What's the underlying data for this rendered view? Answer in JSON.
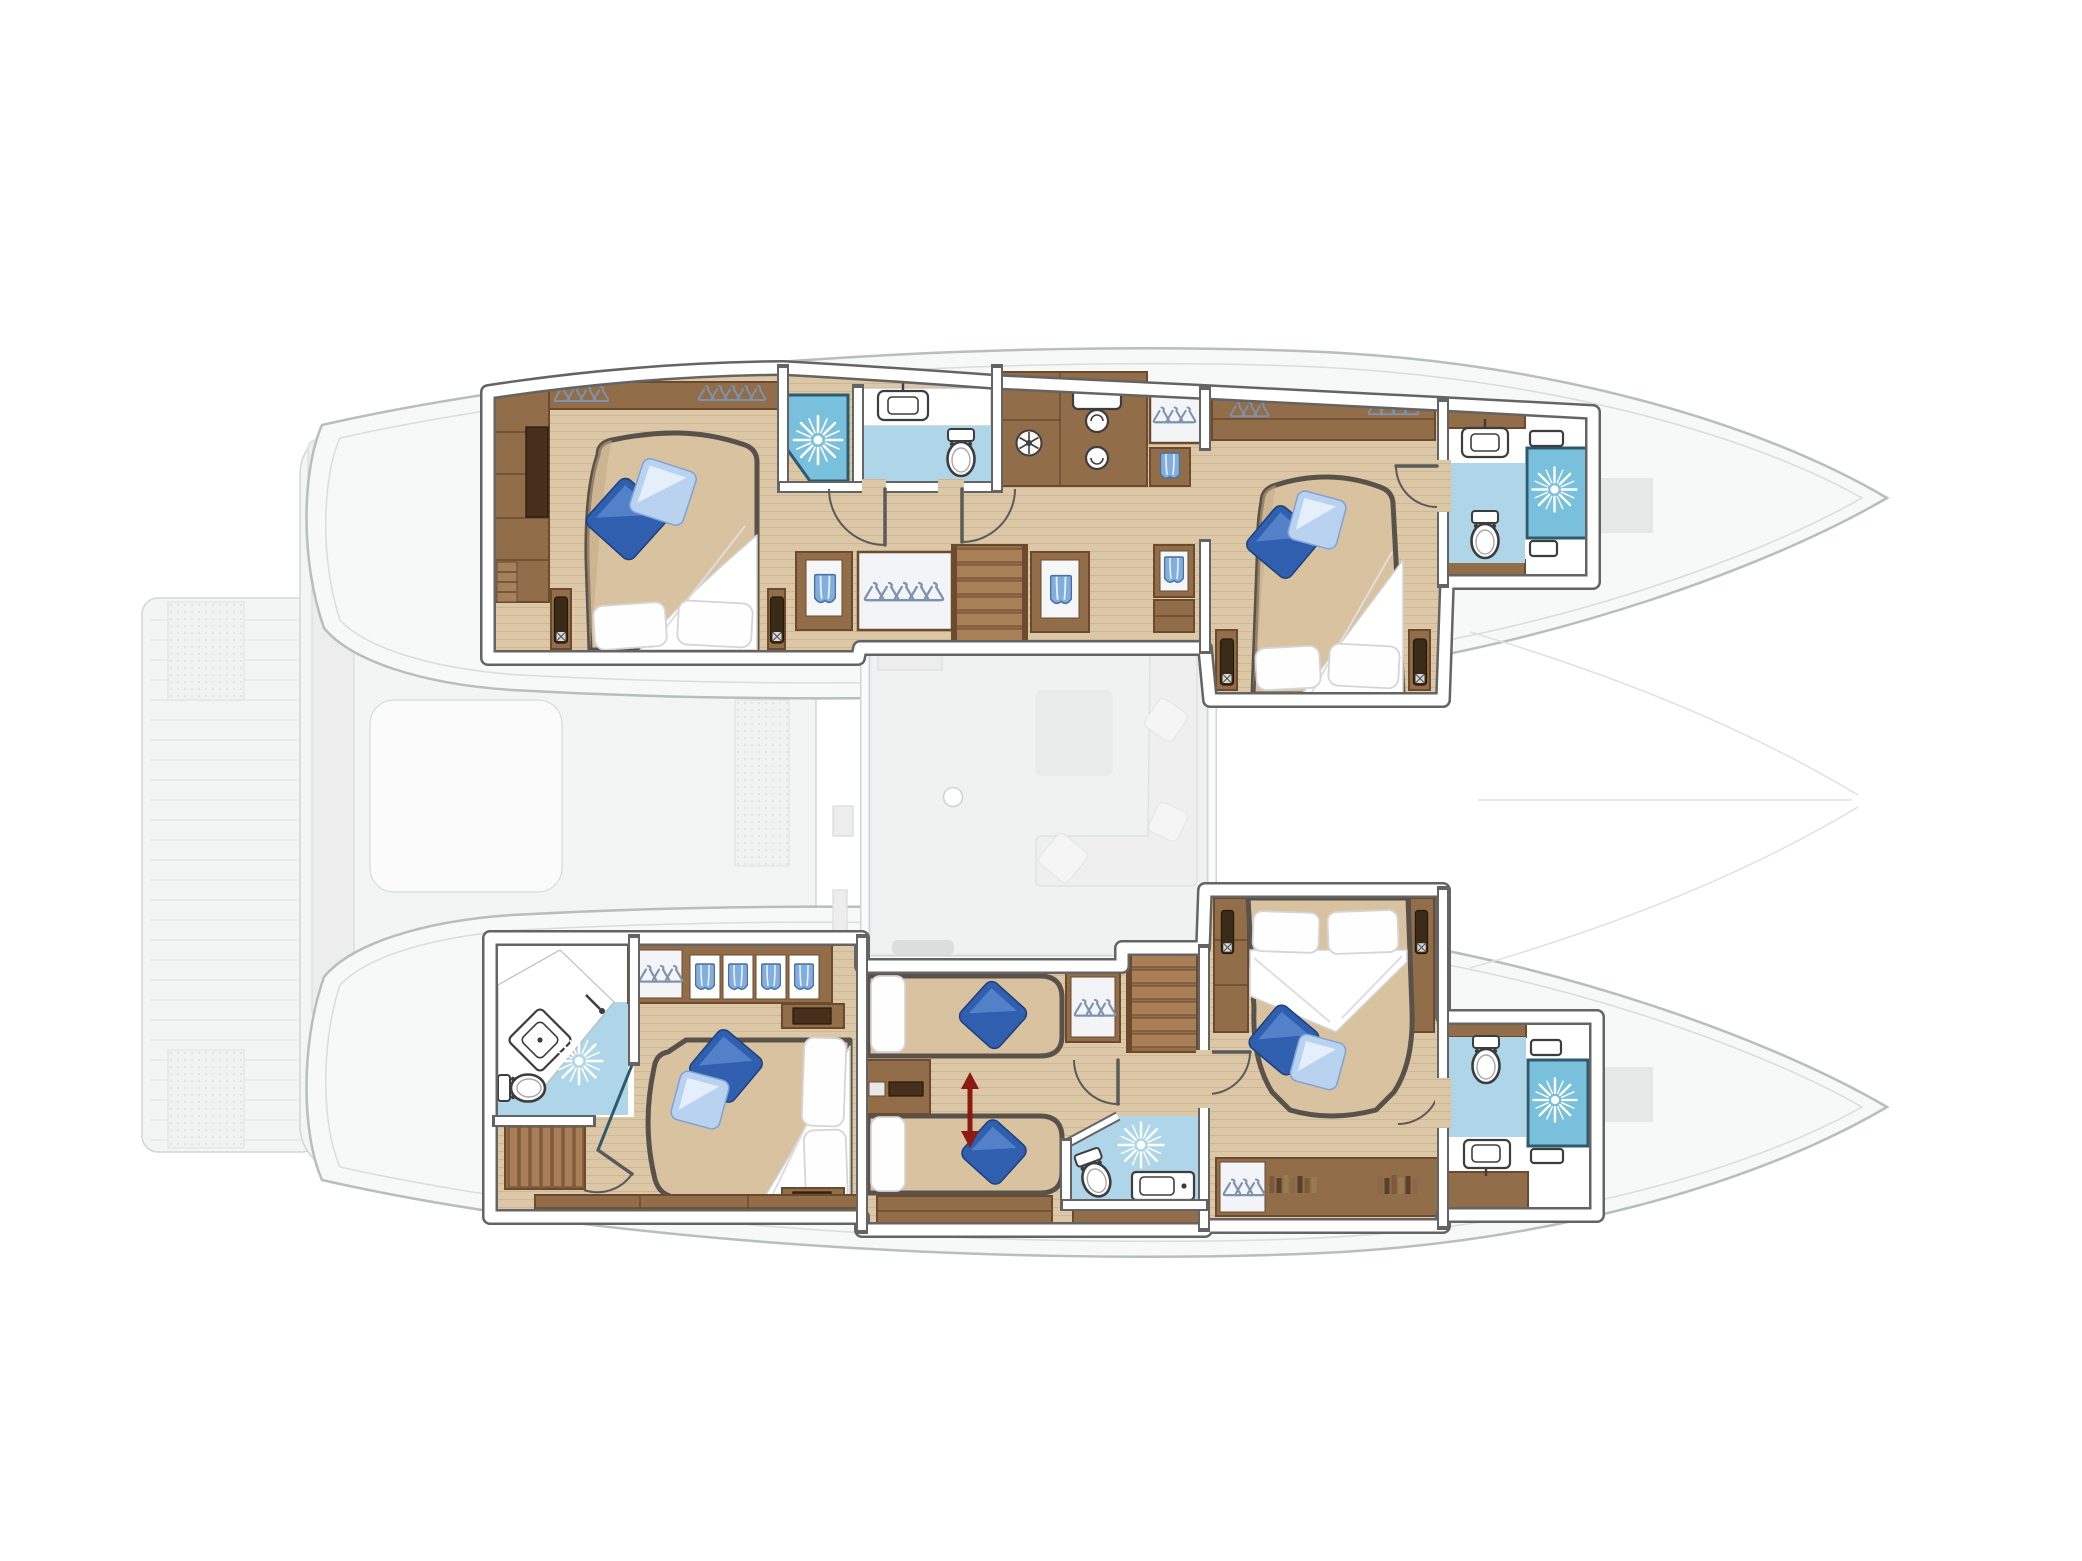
{
  "meta": {
    "type": "yacht floor plan",
    "vessel": "sailing catamaran (twin hulls, bows to the right)",
    "view": "top-down interior deck plan, saloon and exterior decks shown faded",
    "visible_text": []
  },
  "palette": {
    "hullFill": "#f7f8f8",
    "hullLine": "#b7bebe",
    "hullLine2": "#d9dddd",
    "deckFill": "#f3f4f4",
    "deckLine": "#d2d6d6",
    "faintFill": "#ededee",
    "faintLine": "#dfe1e1",
    "platformLine": "#e4e7e7",
    "wallWhite": "#ffffff",
    "wallEdge": "#646464",
    "floorWood": "#dcc7a7",
    "floorWoodLine": "#c3aa85",
    "woodCab": "#916d4a",
    "woodCabDark": "#6b4a2d",
    "woodDeep": "#46301b",
    "stairTread": "#a97f58",
    "mattress": "#d9c29f",
    "mattressShade": "#c3ab87",
    "mattressEdge": "#59524b",
    "bathFloor": "#aed6e8",
    "showerBlue": "#79c0dd",
    "showerFrame": "#2e5a6e",
    "fixtureStroke": "#3d3d3d",
    "cushionDark": "#2f5fae",
    "cushionDarkEdge": "#1d3f7e",
    "cushionDarkHi": "#5b8ad0",
    "cushionLight": "#b9d2f0",
    "cushionLightEdge": "#7fa3d4",
    "hanger": "#7d93ad",
    "towelBlue": "#82aede",
    "towelEdge": "#4a6fa0",
    "arrowRed": "#8b1a12",
    "lampDark": "#3a2a18",
    "starburst": "#ffffff"
  },
  "icons": {
    "starburst": "shower head (rendered as white ray burst on blue floor)",
    "toilet": "toilet bowl with cistern",
    "sink": "washbasin with faucet",
    "diamond-sink": "corner washbasin set at 45 degrees",
    "hanger-row": "hanging wardrobe",
    "towel": "folded towel in cubby",
    "fan": "ventilation / washer unit",
    "red-double-arrow": "twin beds slide together to form a double",
    "quarter-arc": "door swing",
    "slatted-rect": "staircase"
  },
  "counts": {
    "cabins": 5,
    "double_beds": 4,
    "single_beds": 2,
    "bathrooms": 5,
    "showers": 5,
    "toilets": 5,
    "staircases": 3,
    "decorative_blue_pillows": 10
  },
  "rooms": [
    {
      "id": "cabin-port-aft",
      "hull": "port (top)",
      "position": "aft",
      "label": "Port aft double cabin: island bed with two blue pillows, wardrobe column, hanging lockers, two bedside tables with lamps"
    },
    {
      "id": "bathroom-port-mid",
      "hull": "port (top)",
      "position": "midship",
      "label": "Port bathroom: corner shower with glass front, WC compartment with toilet and washbasin"
    },
    {
      "id": "corridor-port",
      "hull": "port (top)",
      "position": "midship",
      "label": "Port companionway: staircase to saloon, utility units with fan and washer-dryer, hanging lockers and towel cubbies"
    },
    {
      "id": "cabin-port-forward",
      "hull": "port (top)",
      "position": "forward",
      "label": "Port forward double cabin: island bed with two blue pillows, overhead lockers, bedside tables"
    },
    {
      "id": "bathroom-port-forward",
      "hull": "port (top)",
      "position": "bow",
      "label": "Port forward bathroom: shower cabin, toilet, washbasin"
    },
    {
      "id": "cabin-starboard-aft",
      "hull": "starboard (bottom)",
      "position": "aft",
      "label": "Starboard aft double cabin: island bed facing aft, towel cubbies and hanging locker, en-suite with corner basin, toilet and shower, private companionway stairs"
    },
    {
      "id": "cabin-starboard-mid",
      "hull": "starboard (bottom)",
      "position": "midship",
      "label": "Starboard mid cabin: two single beds convertible to a double (red arrow), hanging locker, shelf unit"
    },
    {
      "id": "bathroom-starboard-mid",
      "hull": "starboard (bottom)",
      "position": "midship",
      "label": "Starboard mid bathroom: shower, toilet, washbasin"
    },
    {
      "id": "stairs-starboard",
      "hull": "starboard (bottom)",
      "position": "midship",
      "label": "Staircase from saloon down to starboard hull"
    },
    {
      "id": "cabin-starboard-forward",
      "hull": "starboard (bottom)",
      "position": "forward",
      "label": "Starboard forward double cabin: bed with headboard forward, side wardrobes with lamps, book shelves and hanging locker"
    },
    {
      "id": "bathroom-starboard-forward",
      "hull": "starboard (bottom)",
      "position": "bow",
      "label": "Starboard forward bathroom: shower cabin, toilet, washbasin"
    }
  ],
  "faded_exterior": [
    "swim platform with teak stripes (far left)",
    "aft cockpit with table and bench seating",
    "saloon with L-shaped sofa, low table, galley counters and mast foot",
    "forward cockpit benches between the bows",
    "foredeck lines converging to the bows"
  ]
}
